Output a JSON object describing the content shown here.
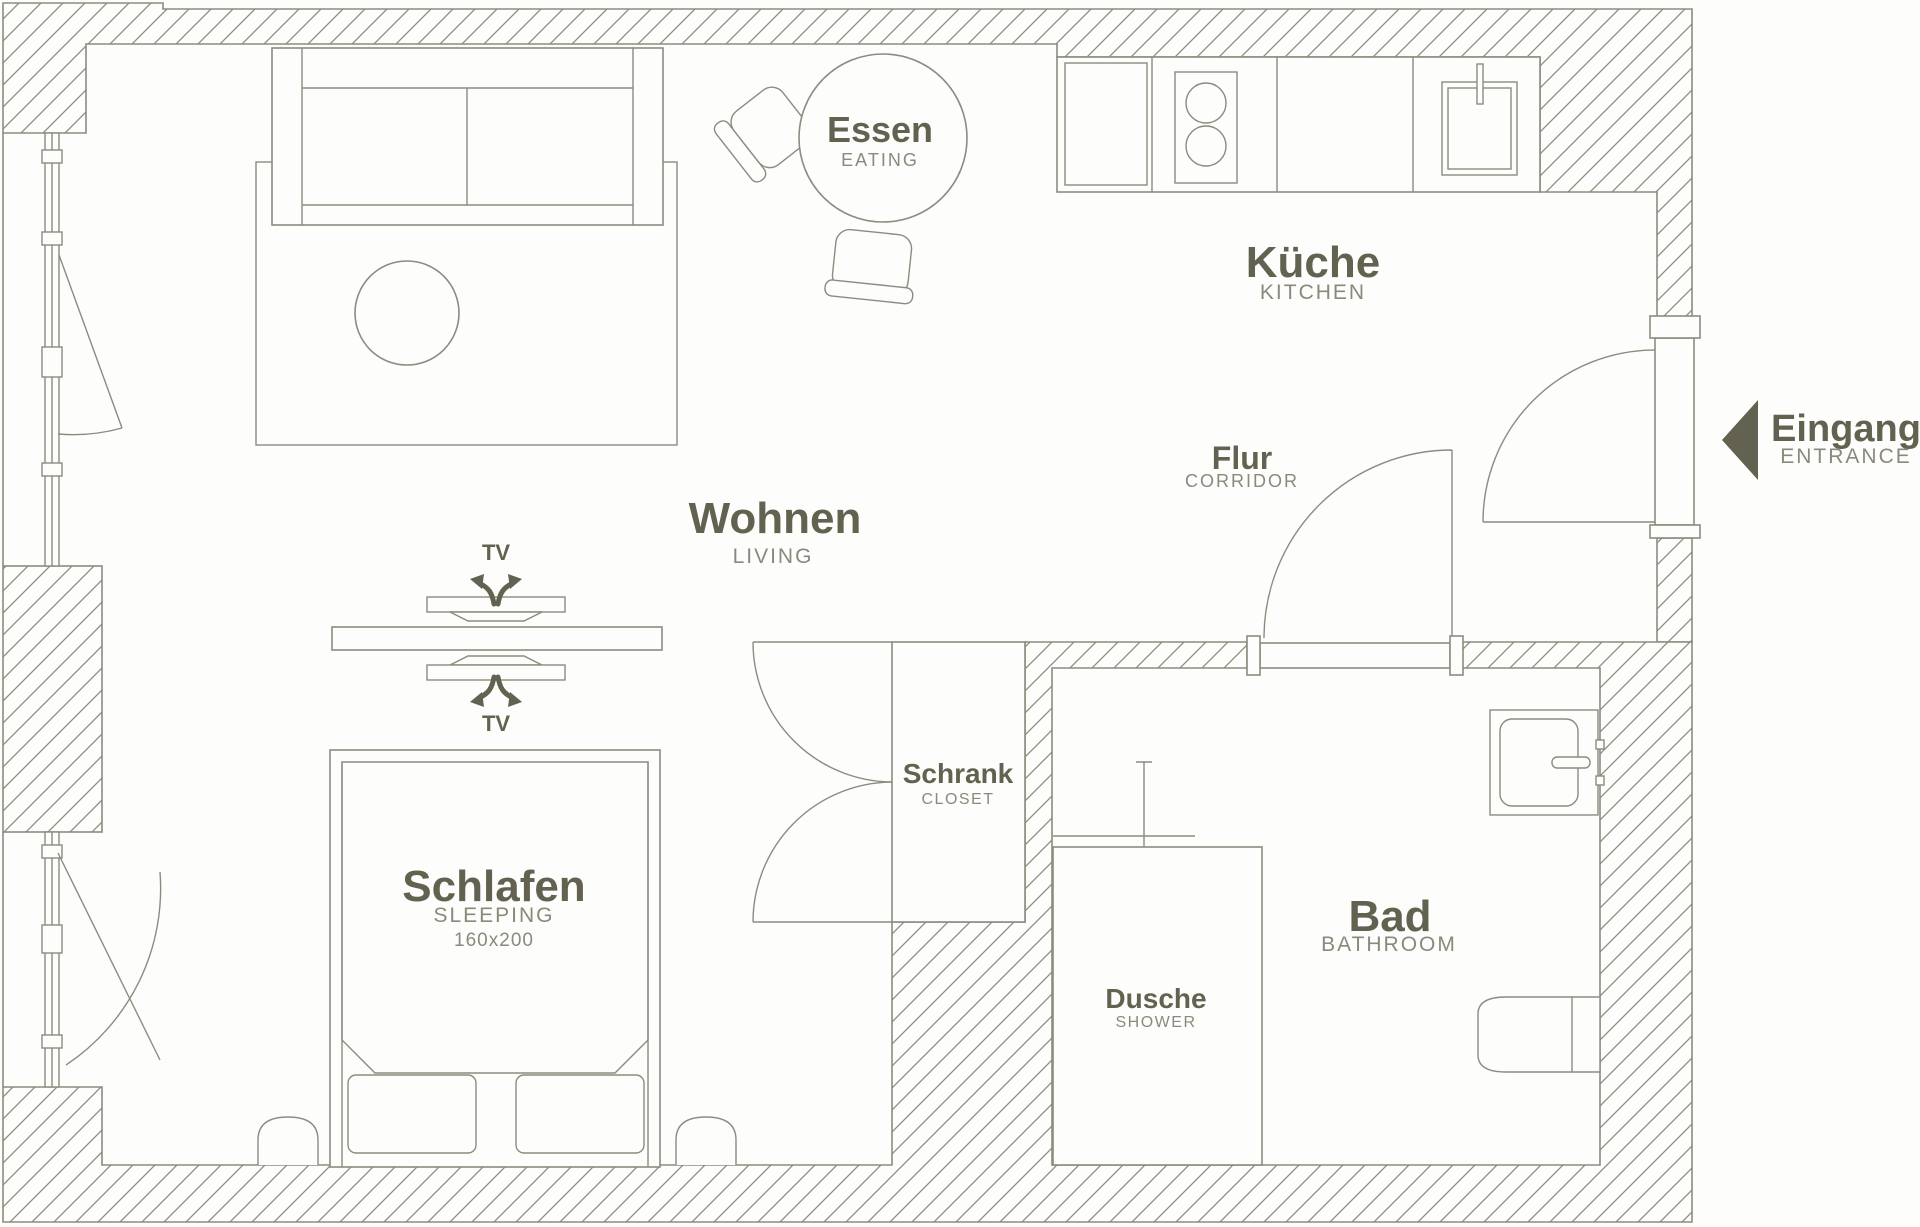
{
  "title": "Apartment floor plan",
  "colors": {
    "background": "#fdfdfb",
    "line": "#8d8b7e",
    "label_primary": "#636250",
    "label_secondary": "#8b897b"
  },
  "rooms": {
    "living": {
      "de": "Wohnen",
      "en": "LIVING"
    },
    "eating": {
      "de": "Essen",
      "en": "EATING"
    },
    "kitchen": {
      "de": "Küche",
      "en": "KITCHEN"
    },
    "corridor": {
      "de": "Flur",
      "en": "CORRIDOR"
    },
    "sleeping": {
      "de": "Schlafen",
      "en": "SLEEPING",
      "bed_size": "160x200"
    },
    "closet": {
      "de": "Schrank",
      "en": "CLOSET"
    },
    "shower": {
      "de": "Dusche",
      "en": "SHOWER"
    },
    "bathroom": {
      "de": "Bad",
      "en": "BATHROOM"
    },
    "entrance": {
      "de": "Eingang",
      "en": "ENTRANCE"
    }
  },
  "annotations": {
    "tv_top": "TV",
    "tv_bottom": "TV"
  }
}
